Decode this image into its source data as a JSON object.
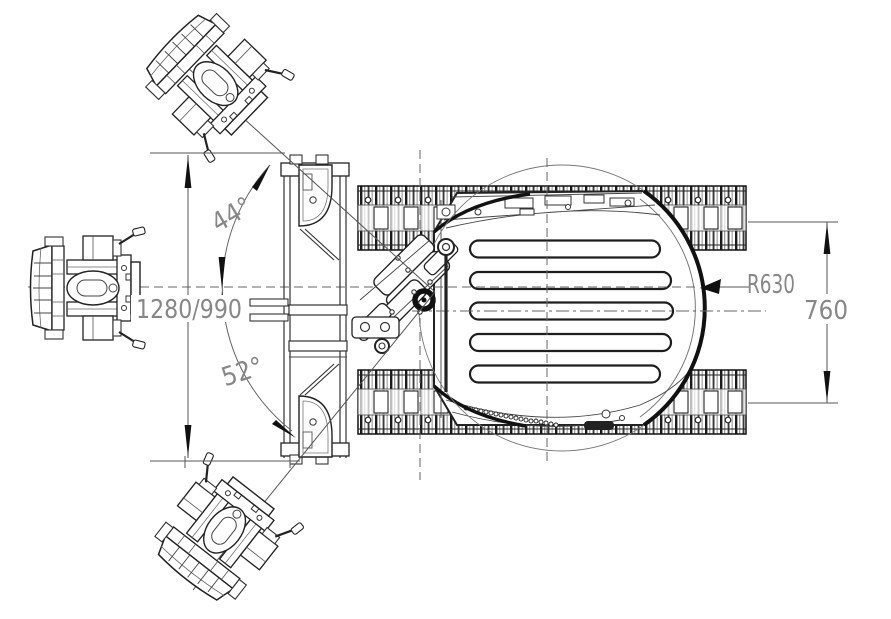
{
  "drawing": {
    "view": "top-view-technical-drawing",
    "dimensions": {
      "upper_swing_angle": "44°",
      "lower_swing_angle": "52°",
      "overall_width": "1280/990",
      "rear_radius": "R630",
      "track_span": "760"
    },
    "colors": {
      "background": "#ffffff",
      "line": "#1c1c1c",
      "dimension_text": "#878787"
    }
  }
}
